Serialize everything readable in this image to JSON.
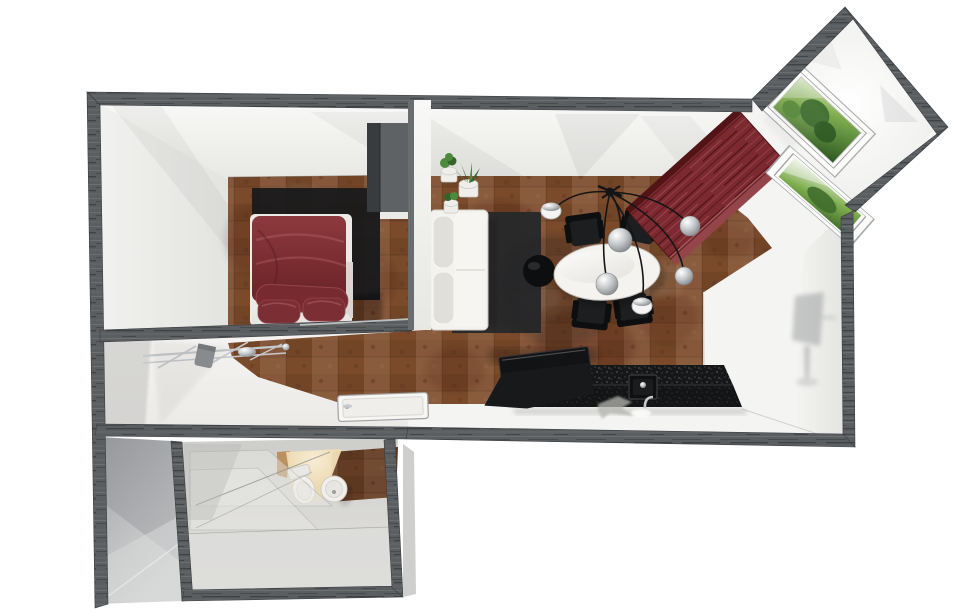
{
  "meta": {
    "title": "Apartment 3D floor plan — top-down dollhouse render",
    "view": "bird's-eye perspective, white walls with dark wood-grain wall tops",
    "background": "#ffffff"
  },
  "colors": {
    "bg": "#ffffff",
    "wall-edge": "#3b3e41",
    "wall-wood": "#5b5e61",
    "wall-face": "#f2f2f0",
    "floor-cork": "#7d4e30",
    "floor-light": "#f2f1ee",
    "rug": "#26282a",
    "bed-base": "#eceae6",
    "bed-duvet": "#7e3034",
    "bed-pillow": "#7b2e33",
    "wardrobe-front": "#5f6265",
    "wardrobe-side": "#393c3f",
    "sofa-base": "#f3f2ee",
    "sofa-cushion": "#e0dfda",
    "pot": "#efeeea",
    "plant": "#4d8a3d",
    "plant-dark": "#33642a",
    "table-top": "#f4f3ef",
    "chair-black": "#1c1e20",
    "chair-dark": "#0d0e0f",
    "pendant-cable": "#141516",
    "chrome": "#c6c9cb",
    "sideboard-red": "#7c2a2f",
    "counter-granite": "#161718",
    "window-green": "#4f7d33",
    "glow-warm": "#f6e7c4",
    "bath-floor": "#d8d8d5",
    "shadow-gray": "#96989a"
  },
  "scene": {
    "rooms": [
      {
        "id": "bedroom",
        "label": "Bedroom",
        "floor": "cork-brown"
      },
      {
        "id": "living-dining",
        "label": "Living / dining room",
        "floor": "cork-brown"
      },
      {
        "id": "kitchen",
        "label": "Kitchen zone",
        "floor": "white-tile"
      },
      {
        "id": "hallway",
        "label": "Hallway / entry",
        "floor": "white-tile"
      },
      {
        "id": "bathroom",
        "label": "Bathroom annex",
        "floor": "gray-tile"
      },
      {
        "id": "bay",
        "label": "Angled window bay",
        "floor": "white"
      }
    ],
    "furniture": {
      "bed": {
        "label": "Double bed with dark red bedding"
      },
      "bed_platform": {
        "label": "Dark bed platform rug"
      },
      "wardrobe": {
        "label": "Gray wardrobe cabinet"
      },
      "sofa": {
        "label": "White two-seat sofa"
      },
      "plants": {
        "label": "Potted green plants (3)"
      },
      "rug": {
        "label": "Charcoal area rug"
      },
      "side_table": {
        "label": "Round black side table"
      },
      "dining_table": {
        "label": "White oval dining table"
      },
      "chairs": {
        "label": "Black dining chairs (4)"
      },
      "pendant": {
        "label": "Multi-arm pendant lamp with 6 chrome shades"
      },
      "sideboard": {
        "label": "Dark red wood sideboard (angled in bay)"
      },
      "counter": {
        "label": "Black granite kitchen counter"
      },
      "cooktop": {
        "label": "Black cooktop unit"
      },
      "sink": {
        "label": "Kitchen sink with chrome faucet"
      },
      "coat_rack": {
        "label": "Chrome wall-mounted coat rack"
      },
      "door": {
        "label": "White interior door (plan view)"
      },
      "toilet": {
        "label": "Toilet"
      },
      "bidet": {
        "label": "Round ceramic fixture"
      },
      "shower_glass": {
        "label": "Glass shower partition"
      },
      "window_large": {
        "label": "Large bay window with garden view"
      },
      "window_small": {
        "label": "Small bay window with garden view"
      }
    }
  }
}
